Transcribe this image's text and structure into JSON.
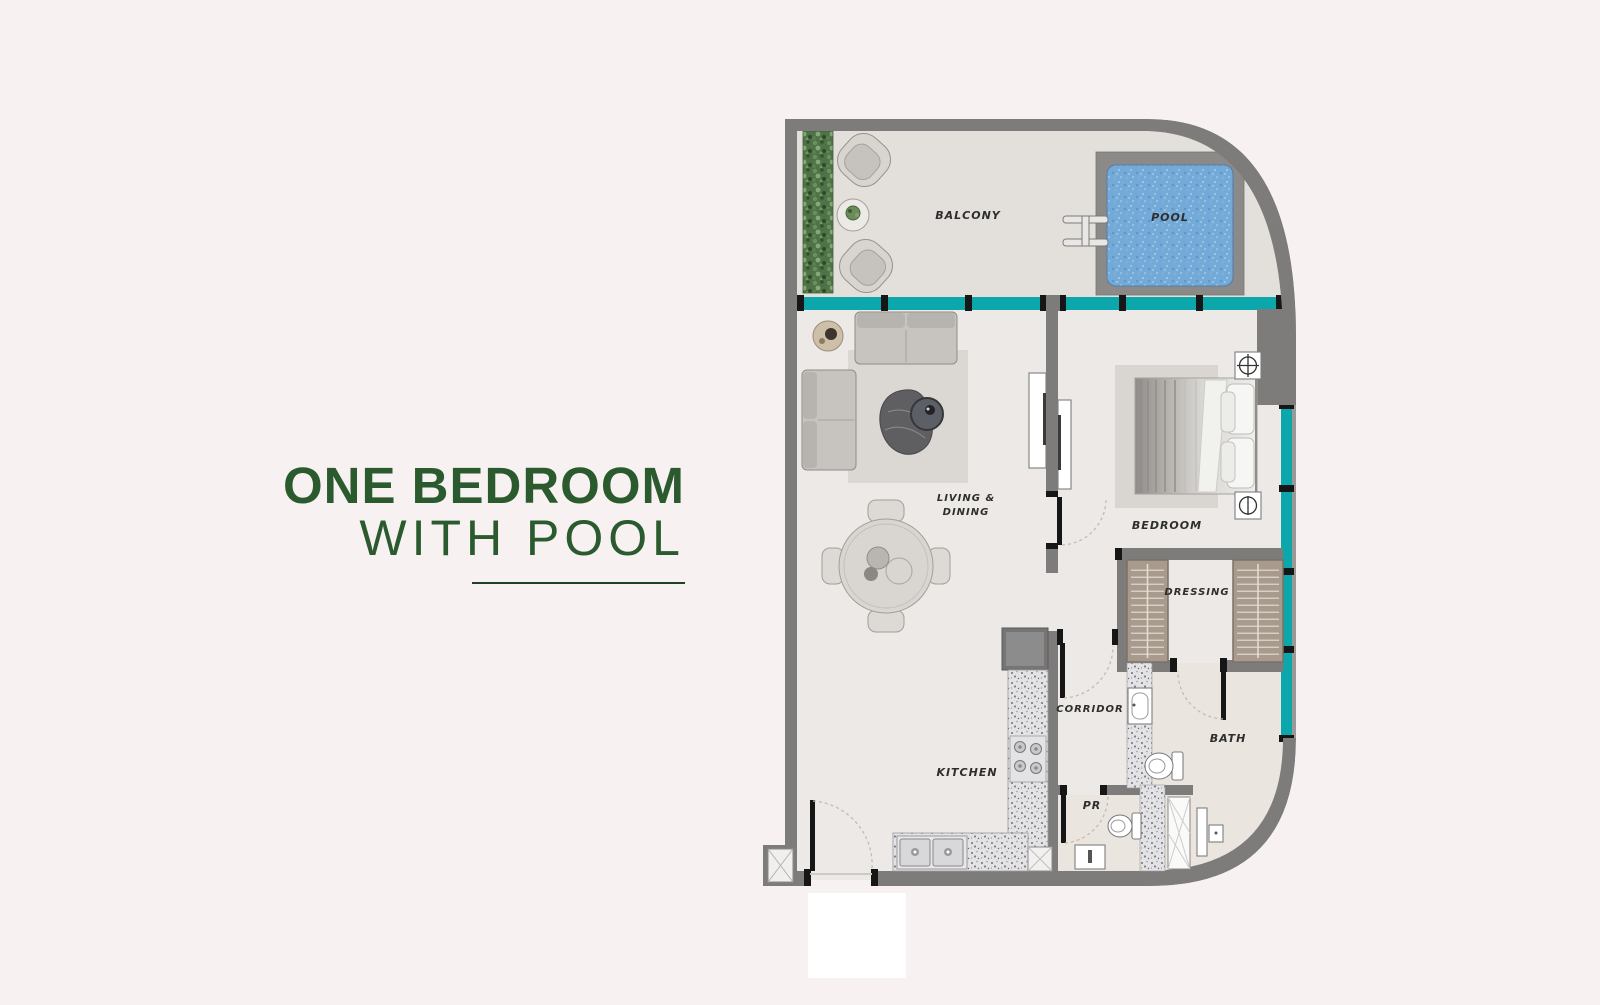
{
  "page": {
    "background": "#f7f2f1"
  },
  "title": {
    "line1": "ONE BEDROOM",
    "line2": "WITH POOL",
    "color": "#2b5a2f",
    "rule_color": "#203f27"
  },
  "plan": {
    "labels": {
      "balcony": "BALCONY",
      "pool": "POOL",
      "living1": "LIVING &",
      "living2": "DINING",
      "bedroom": "BEDROOM",
      "dressing": "DRESSING",
      "corridor": "CORRIDOR",
      "kitchen": "KITCHEN",
      "bath": "BATH",
      "pr": "PR"
    },
    "colors": {
      "wall": "#7d7c7a",
      "window_glass": "#0ba7aa",
      "pool_water": "#74aad8",
      "pool_deck": "#8b8a88",
      "interior_floor": "#ece9e6",
      "balcony_floor": "#e3e0dc",
      "bath_floor": "#eae5df",
      "rug": "#dbd8d4",
      "wardrobe": "#a89b8d",
      "hedge": "#4f7347"
    }
  }
}
